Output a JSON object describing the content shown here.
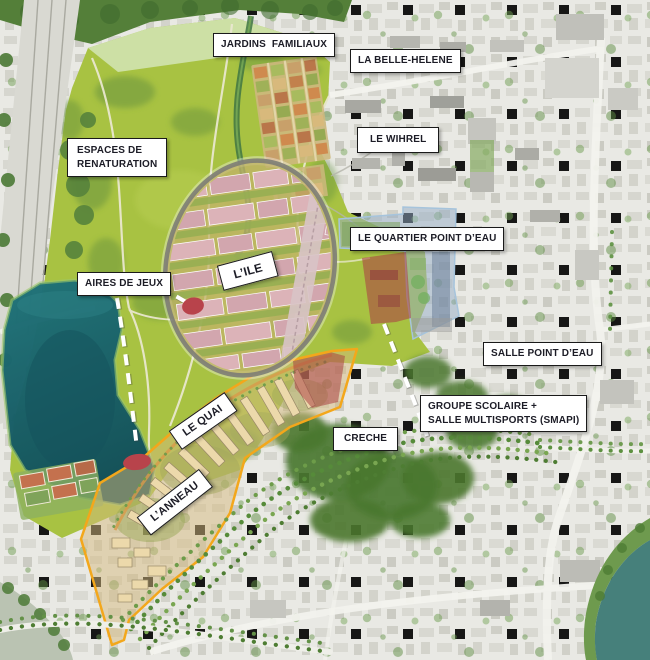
{
  "map": {
    "kind": "urban-masterplan-aerial",
    "labels": {
      "jardins_familiaux": "JARDINS FAMILIAUX",
      "la_belle_helene": "LA BELLE-HELENE",
      "le_wihrel": "LE WIHREL",
      "espaces_de_renaturation": {
        "line1": "ESPACES DE",
        "line2": "RENATURATION"
      },
      "le_quartier_point_deau": "LE QUARTIER POINT D’EAU",
      "l_ile": "L’ILE",
      "aires_de_jeux": "AIRES DE JEUX",
      "salle_point_deau": "SALLE POINT D’EAU",
      "groupe_scolaire": {
        "line1": "GROUPE SCOLAIRE +",
        "line2": "SALLE MULTISPORTS (SMAPI)"
      },
      "creche": "CRECHE",
      "le_quai": "LE QUAI",
      "l_anneau": "L’ANNEAU"
    },
    "markers": {
      "playground_count": 2
    },
    "colors": {
      "label_text": "#1c1c26",
      "label_background": "#ffffff",
      "label_border": "#1a1a1a",
      "park_green": "#a8c242",
      "lake_teal": "#1c6b73",
      "district_outline_orange": "#f3a71b",
      "overlay_blue": "#93acc5",
      "overlay_red": "#ac4444",
      "marker_red": "#b8434b",
      "annotation_dash_white": "#ffffff"
    }
  }
}
